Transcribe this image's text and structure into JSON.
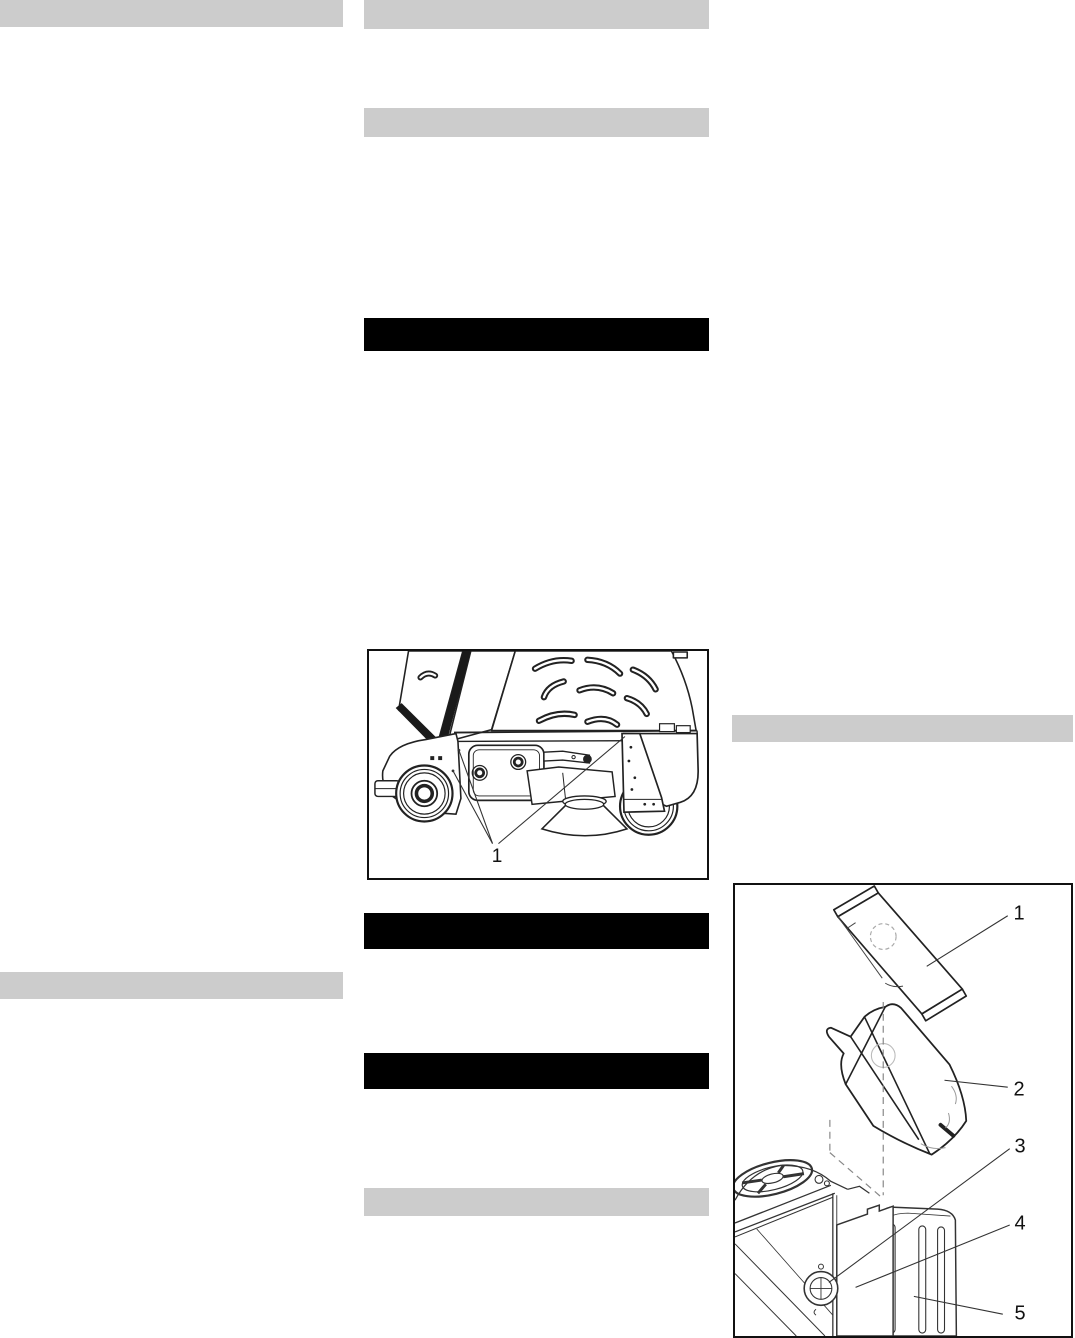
{
  "colors": {
    "page_background": "#ffffff",
    "redaction_gray": "#cccccc",
    "redaction_black": "#000000",
    "line_art": "#222222"
  },
  "figures": {
    "machine_side_view": {
      "callouts": [
        {
          "label": "1"
        }
      ]
    },
    "bag_installation": {
      "callouts": [
        {
          "label": "1"
        },
        {
          "label": "2"
        },
        {
          "label": "3"
        },
        {
          "label": "4"
        },
        {
          "label": "5"
        }
      ]
    }
  }
}
